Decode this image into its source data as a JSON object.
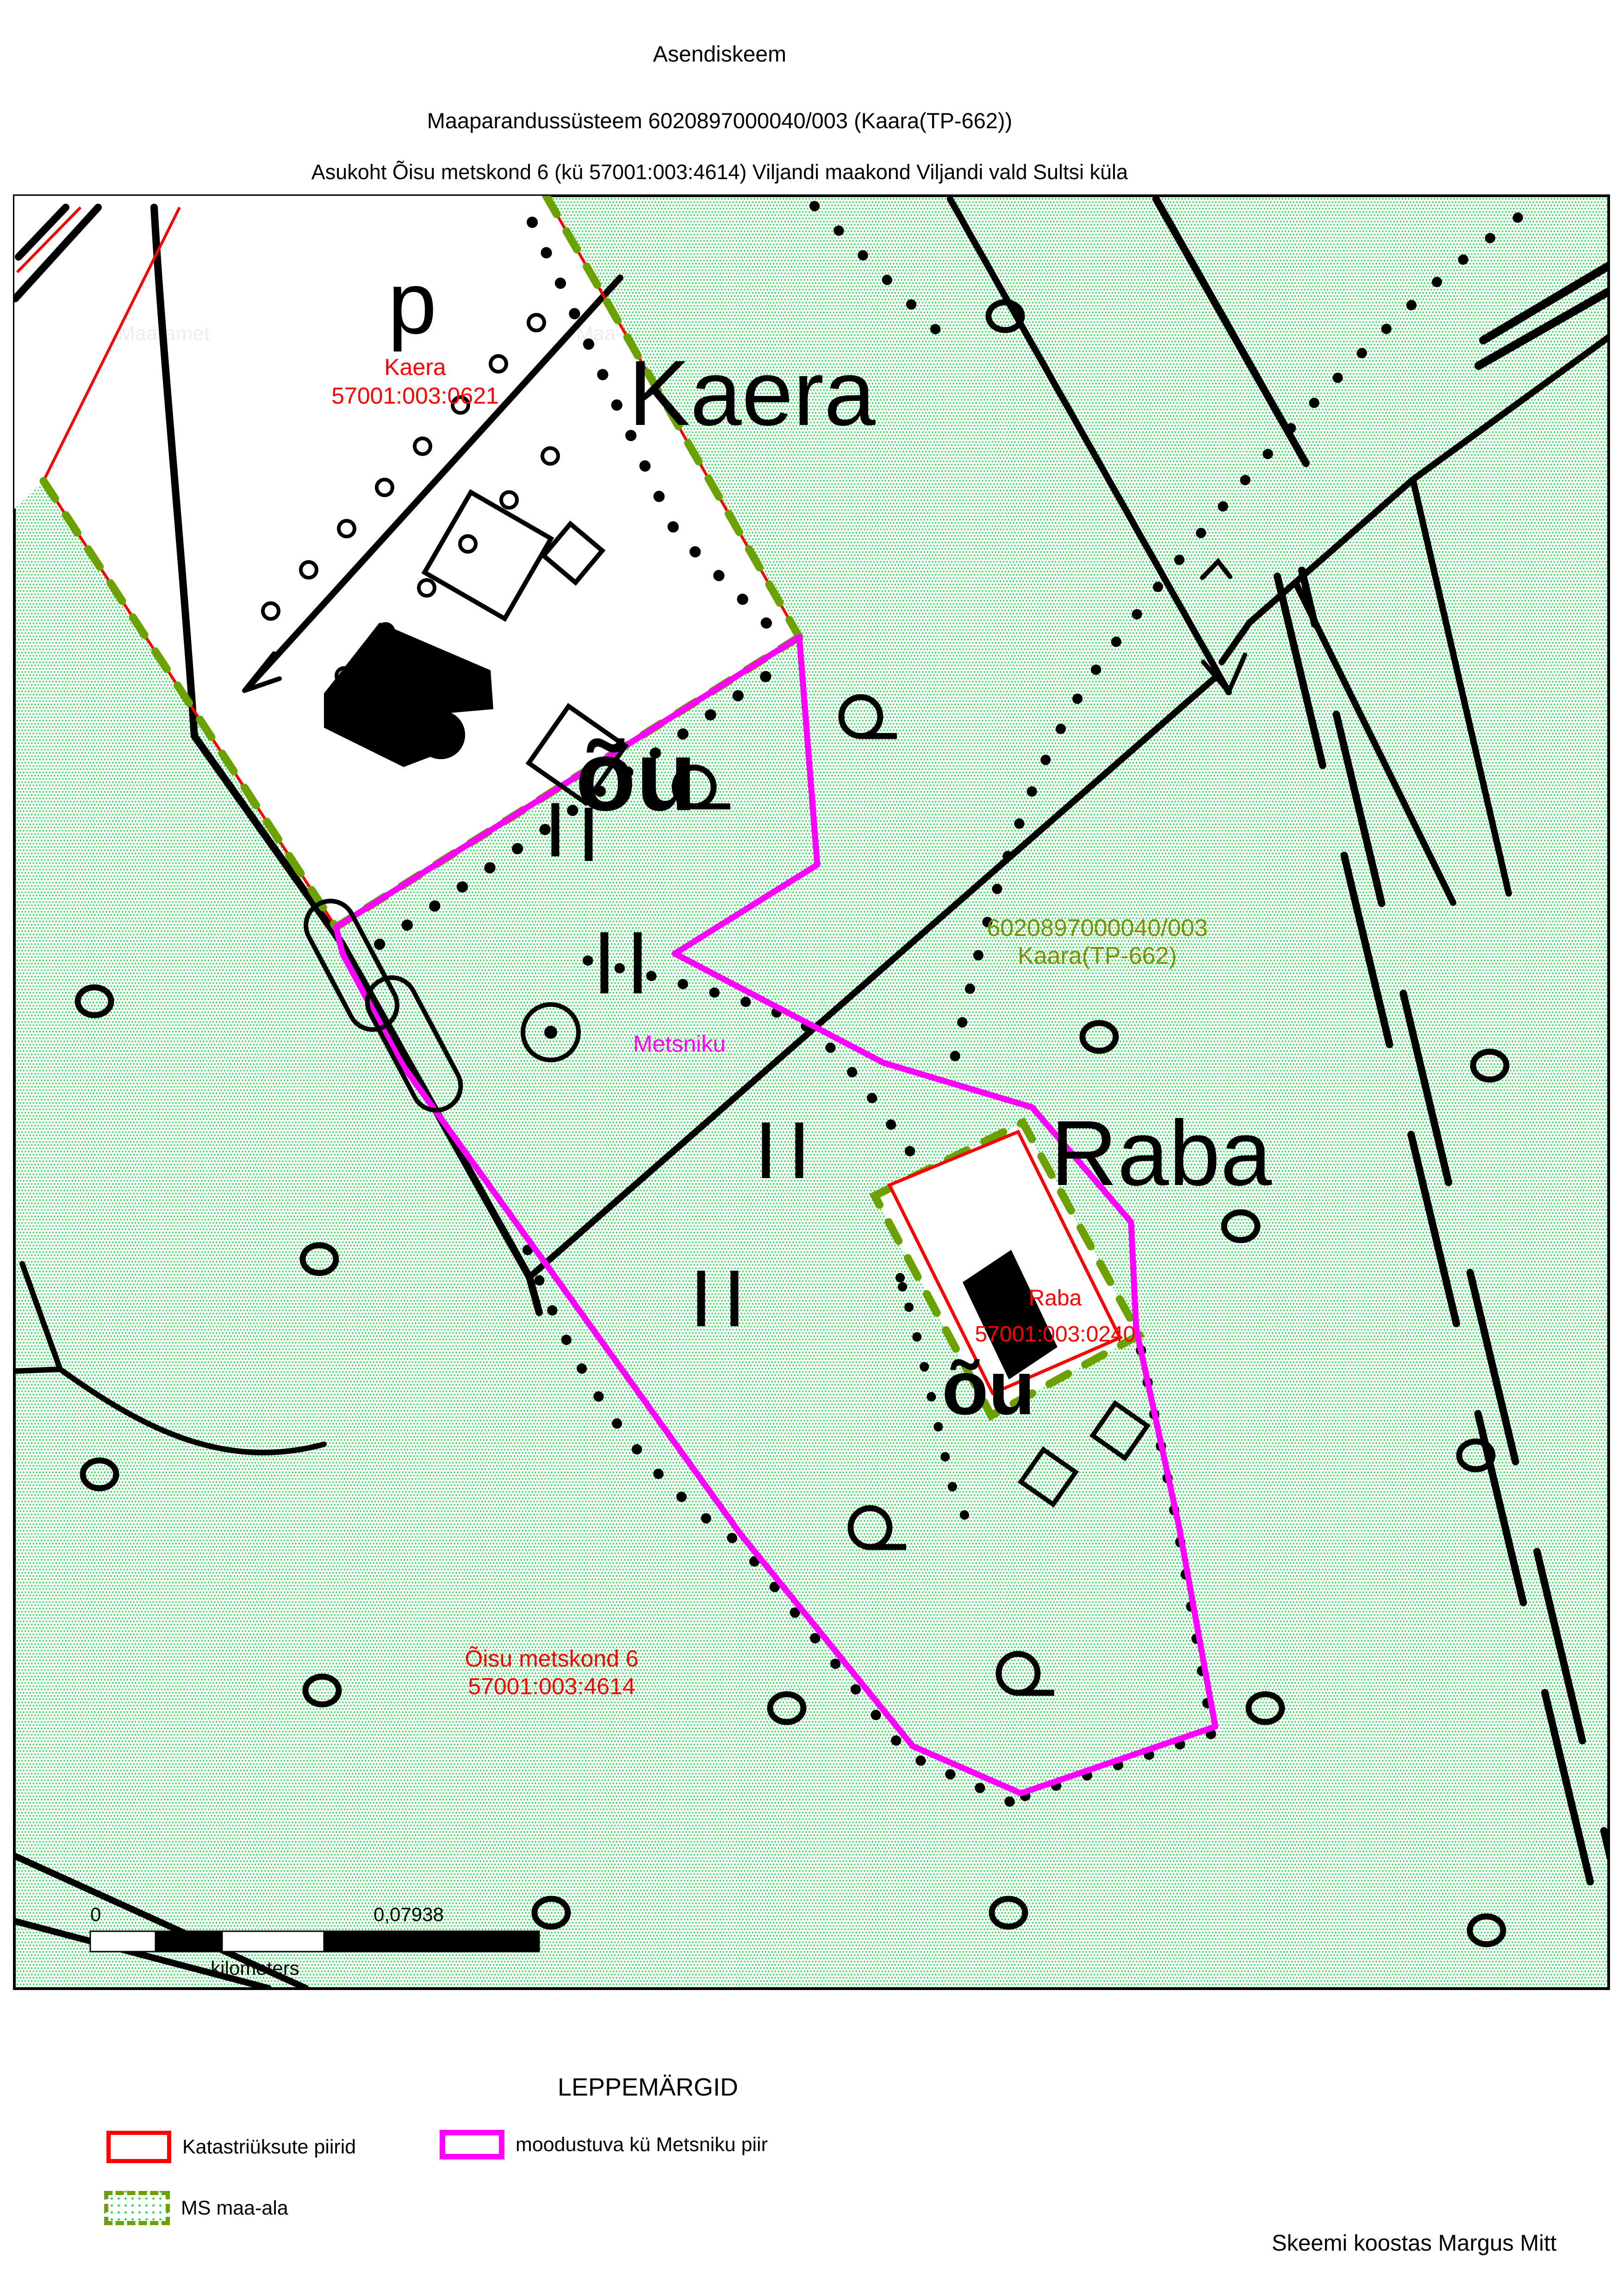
{
  "header": {
    "line1": "Asendiskeem",
    "line2": "Maaparandussüsteem 6020897000040/003 (Kaara(TP-662))",
    "line3": "Asukoht Õisu metskond 6 (kü 57001:003:4614) Viljandi maakond Viljandi vald Sultsi küla"
  },
  "map": {
    "place_labels": {
      "kaera": "Kaera",
      "raba": "Raba",
      "p": "p",
      "ou_kaera": "õu",
      "ou_raba": "õu"
    },
    "cadastral_labels": {
      "kaera": {
        "name": "Kaera",
        "code": "57001:003:0621"
      },
      "raba": {
        "name": "Raba",
        "code": "57001:003:0240"
      },
      "oisu": {
        "name": "Õisu metskond 6",
        "code": "57001:003:4614"
      }
    },
    "system_label": {
      "line1": "6020897000040/003",
      "line2": "Kaara(TP-662)"
    },
    "metsniku_label": "Metsniku",
    "watermark": "Maa-amet",
    "scalebar": {
      "start": "0",
      "end": "0,07938",
      "units": "kilometers"
    },
    "colors": {
      "cadastral_boundary": "#ff0000",
      "ms_area_boundary": "#6ca103",
      "metsniku_boundary": "#ff00ff",
      "background_dots": "#00dd33",
      "system_label_text": "#7d9100",
      "cadastral_label_text": "#ff0000"
    }
  },
  "legend": {
    "title": "LEPPEMÄRGID",
    "items": [
      {
        "label": "Katastriüksute piirid"
      },
      {
        "label": "moodustuva kü Metsniku piir"
      },
      {
        "label": "MS maa-ala"
      }
    ]
  },
  "footer": {
    "credit": "Skeemi koostas Margus Mitt"
  }
}
